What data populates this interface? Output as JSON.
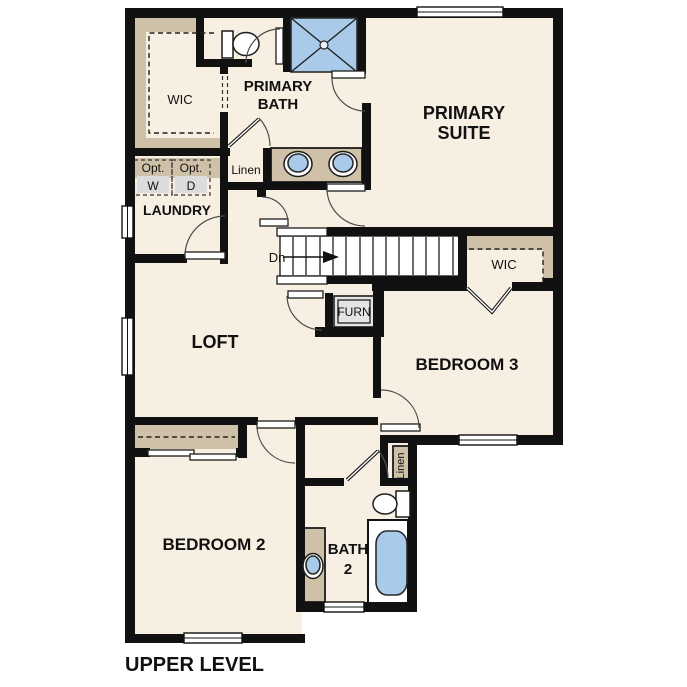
{
  "plan_type": "floor-plan",
  "level_title": "UPPER LEVEL",
  "colors": {
    "floor": "#f7efe2",
    "wall": "#111111",
    "millwork_tan": "#cec1a7",
    "fixture_blue": "#a9cae8",
    "appliance_gray": "#dcdcdc",
    "background": "#ffffff"
  },
  "labels": {
    "wic_primary": "WIC",
    "primary_bath_line1": "PRIMARY",
    "primary_bath_line2": "BATH",
    "primary_suite_line1": "PRIMARY",
    "primary_suite_line2": "SUITE",
    "opt_washer_line1": "Opt.",
    "opt_washer_line2": "W",
    "opt_dryer_line1": "Opt.",
    "opt_dryer_line2": "D",
    "laundry": "LAUNDRY",
    "linen_hall": "Linen",
    "stairs_direction": "Dn",
    "wic_bedroom3": "WIC",
    "furnace": "FURN",
    "loft": "LOFT",
    "bedroom3": "BEDROOM 3",
    "bedroom2": "BEDROOM 2",
    "bath2_line1": "BATH",
    "bath2_line2": "2",
    "linen_bath2": "Linen",
    "level_title": "UPPER LEVEL"
  }
}
